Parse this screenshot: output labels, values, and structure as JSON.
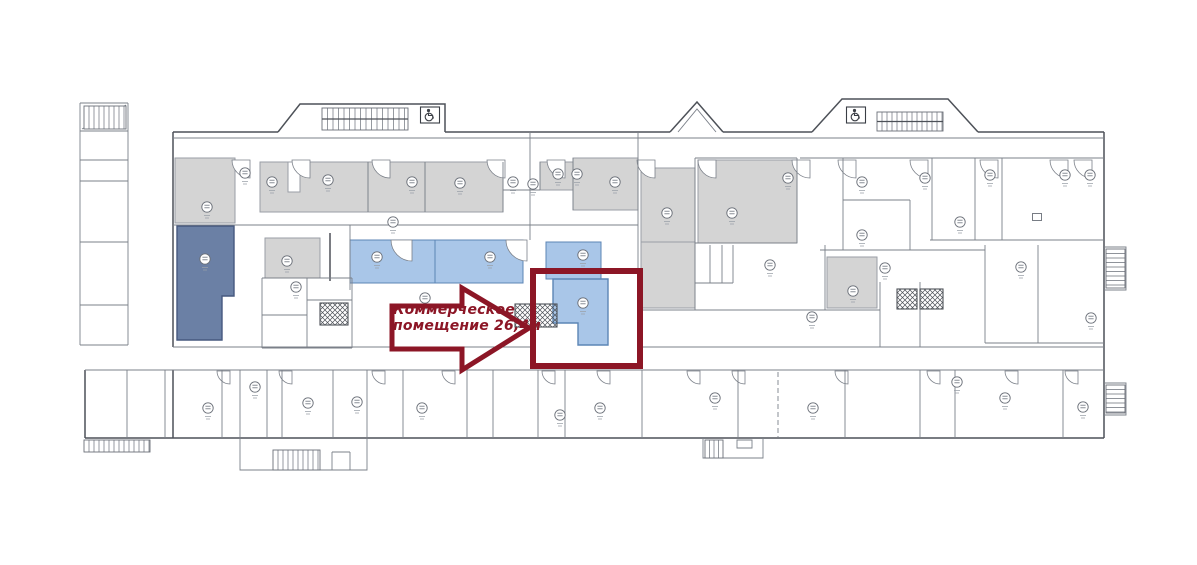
{
  "canvas": {
    "width": 1197,
    "height": 565
  },
  "annotation": {
    "line1": "Коммерческое",
    "line2": "помещение 26,4м"
  },
  "colors": {
    "background": "#ffffff",
    "wall": "#4d5158",
    "wall_light": "#7b8089",
    "gray_room": "#d4d4d4",
    "gray_border": "#9a9ea6",
    "blue_room": "#a9c6e8",
    "blue_border": "#5c85b5",
    "slate_room": "#6b80a5",
    "slate_border": "#46597f",
    "accent_red": "#8c1626"
  },
  "rooms": [
    {
      "name": "room-gray-a",
      "kind": "gray",
      "shape": "rect",
      "x": 175,
      "y": 158,
      "w": 60,
      "h": 65
    },
    {
      "name": "room-gray-b",
      "kind": "gray",
      "shape": "rect",
      "x": 260,
      "y": 162,
      "w": 108,
      "h": 50
    },
    {
      "name": "room-gray-c",
      "kind": "gray",
      "shape": "rect",
      "x": 368,
      "y": 162,
      "w": 57,
      "h": 50
    },
    {
      "name": "room-gray-d",
      "kind": "gray",
      "shape": "rect",
      "x": 425,
      "y": 162,
      "w": 78,
      "h": 50
    },
    {
      "name": "room-gray-e",
      "kind": "gray",
      "shape": "rect",
      "x": 540,
      "y": 162,
      "w": 33,
      "h": 28
    },
    {
      "name": "room-gray-f",
      "kind": "gray",
      "shape": "rect",
      "x": 573,
      "y": 158,
      "w": 65,
      "h": 52
    },
    {
      "name": "room-gray-g",
      "kind": "gray",
      "shape": "rect",
      "x": 641,
      "y": 168,
      "w": 54,
      "h": 74
    },
    {
      "name": "room-gray-h",
      "kind": "gray",
      "shape": "rect",
      "x": 641,
      "y": 242,
      "w": 54,
      "h": 66
    },
    {
      "name": "room-gray-i",
      "kind": "gray",
      "shape": "rect",
      "x": 698,
      "y": 160,
      "w": 99,
      "h": 83
    },
    {
      "name": "room-gray-j",
      "kind": "gray",
      "shape": "rect",
      "x": 827,
      "y": 257,
      "w": 50,
      "h": 51
    },
    {
      "name": "room-gray-p",
      "kind": "gray",
      "shape": "rect",
      "x": 265,
      "y": 238,
      "w": 55,
      "h": 40
    },
    {
      "name": "closet-slot",
      "kind": "white",
      "shape": "rect",
      "x": 288,
      "y": 162,
      "w": 12,
      "h": 30
    },
    {
      "name": "room-slate",
      "kind": "slate",
      "shape": "poly",
      "points": "177,226 234,226 234,296 222,296 222,340 177,340"
    },
    {
      "name": "room-blue-1",
      "kind": "blue",
      "shape": "rect",
      "x": 350,
      "y": 240,
      "w": 85,
      "h": 43
    },
    {
      "name": "room-blue-2",
      "kind": "blue",
      "shape": "rect",
      "x": 435,
      "y": 240,
      "w": 88,
      "h": 43
    },
    {
      "name": "room-blue-3",
      "kind": "blue",
      "shape": "rect",
      "x": 546,
      "y": 242,
      "w": 55,
      "h": 37
    },
    {
      "name": "room-highlight-commercial",
      "kind": "highlight",
      "shape": "poly",
      "points": "553,279 608,279 608,345 578,345 578,323 553,323"
    }
  ],
  "highlight": {
    "box": {
      "x": 533,
      "y": 271,
      "w": 107,
      "h": 95,
      "stroke_width": 6
    },
    "arrow": {
      "points": "392,306 462,306 462,288 529,328 462,370 462,349 392,349",
      "stroke_width": 5
    }
  },
  "door_arcs": {
    "top_y": 160,
    "top_r": 18,
    "top_x": [
      250,
      310,
      390,
      505,
      565,
      655,
      716,
      810,
      856,
      928,
      998,
      1068,
      1092
    ],
    "mid": [
      [
        412,
        240,
        21
      ],
      [
        527,
        240,
        21
      ]
    ],
    "bottom_y": 371,
    "bottom_r": 13,
    "bottom_x": [
      230,
      292,
      385,
      455,
      555,
      610,
      700,
      745,
      848,
      940,
      1018,
      1078
    ]
  },
  "markers": [
    [
      207,
      207
    ],
    [
      245,
      173
    ],
    [
      272,
      182
    ],
    [
      328,
      180
    ],
    [
      412,
      182
    ],
    [
      460,
      183
    ],
    [
      513,
      182
    ],
    [
      533,
      184
    ],
    [
      558,
      174
    ],
    [
      577,
      174
    ],
    [
      615,
      182
    ],
    [
      667,
      213
    ],
    [
      732,
      213
    ],
    [
      788,
      178
    ],
    [
      862,
      182
    ],
    [
      925,
      178
    ],
    [
      990,
      175
    ],
    [
      1065,
      175
    ],
    [
      1090,
      175
    ],
    [
      960,
      222
    ],
    [
      393,
      222
    ],
    [
      205,
      259
    ],
    [
      287,
      261
    ],
    [
      296,
      287
    ],
    [
      377,
      257
    ],
    [
      490,
      257
    ],
    [
      583,
      255
    ],
    [
      583,
      303
    ],
    [
      425,
      298
    ],
    [
      770,
      265
    ],
    [
      812,
      317
    ],
    [
      853,
      291
    ],
    [
      885,
      268
    ],
    [
      1021,
      267
    ],
    [
      1091,
      318
    ],
    [
      862,
      235
    ],
    [
      208,
      408
    ],
    [
      255,
      387
    ],
    [
      308,
      403
    ],
    [
      357,
      402
    ],
    [
      422,
      408
    ],
    [
      560,
      415
    ],
    [
      600,
      408
    ],
    [
      715,
      398
    ],
    [
      813,
      408
    ],
    [
      957,
      382
    ],
    [
      1005,
      398
    ],
    [
      1083,
      407
    ]
  ],
  "mini_squares": [
    [
      1037,
      217
    ]
  ],
  "crosshatch_boxes": [
    [
      320,
      303,
      28,
      22
    ],
    [
      515,
      304,
      42,
      23
    ],
    [
      897,
      289,
      20,
      20
    ],
    [
      920,
      289,
      23,
      20
    ]
  ],
  "stairs": [
    {
      "x": 84,
      "y": 106,
      "w": 42,
      "h": 23,
      "dir": "v",
      "step": 5
    },
    {
      "x": 322,
      "y": 108,
      "w": 86,
      "h": 22,
      "dir": "v",
      "step": 5.5,
      "mid": true
    },
    {
      "x": 877,
      "y": 112,
      "w": 66,
      "h": 19,
      "dir": "v",
      "step": 5,
      "mid": true
    },
    {
      "x": 84,
      "y": 440,
      "w": 66,
      "h": 12,
      "dir": "v",
      "step": 5
    },
    {
      "x": 273,
      "y": 450,
      "w": 47,
      "h": 20,
      "dir": "v",
      "step": 5
    },
    {
      "x": 705,
      "y": 440,
      "w": 18,
      "h": 18,
      "dir": "v",
      "step": 4.5
    },
    {
      "x": 1106,
      "y": 249,
      "w": 19,
      "h": 39,
      "dir": "h",
      "step": 4.5
    },
    {
      "x": 1106,
      "y": 385,
      "w": 19,
      "h": 28,
      "dir": "h",
      "step": 4.5
    }
  ],
  "icons": [
    {
      "name": "wheelchair-icon",
      "x": 430,
      "y": 115
    },
    {
      "name": "wheelchair-icon",
      "x": 856,
      "y": 115
    }
  ]
}
